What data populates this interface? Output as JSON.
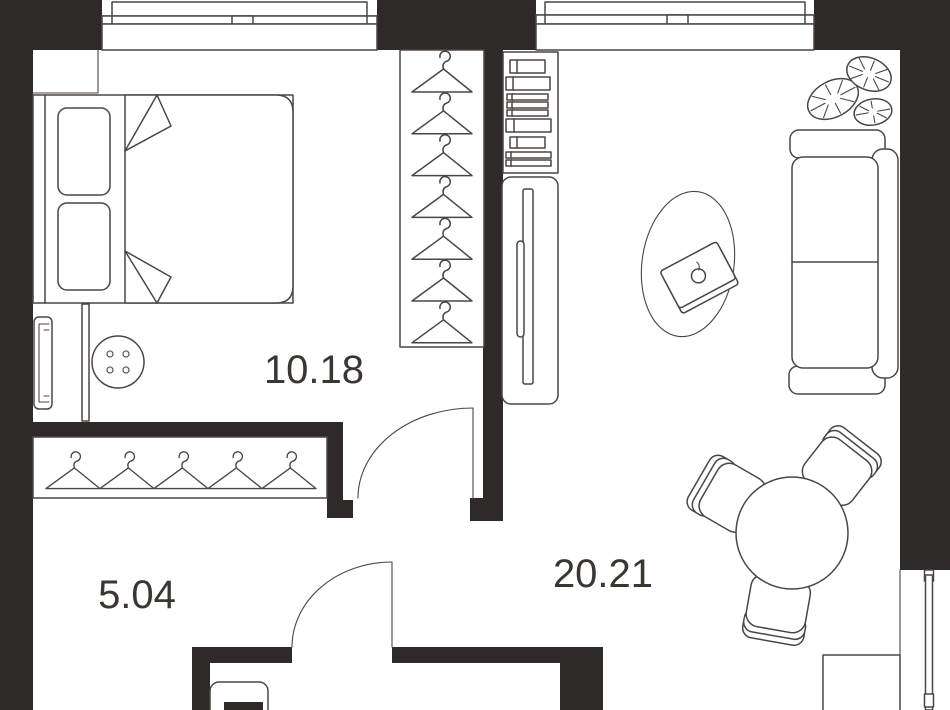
{
  "plan": {
    "type": "apartment-floor-plan",
    "rooms": [
      {
        "id": "bedroom",
        "area_label": "10.18"
      },
      {
        "id": "hallway",
        "area_label": "5.04"
      },
      {
        "id": "living_room",
        "area_label": "20.21"
      }
    ]
  },
  "colors": {
    "wall": "#2e2a27",
    "line": "#4b4643",
    "label": "#3a3632",
    "bg": "#ffffff"
  },
  "wardrobe": {
    "closet_hanger_count": 7,
    "coat_hanger_count": 5
  },
  "icons": [
    "hanger-icon",
    "double-bed",
    "pillow",
    "blanket",
    "radiator",
    "pouf",
    "shelf-unit",
    "tall-cabinet",
    "rug",
    "coffee-table",
    "sofa",
    "monstera-plant",
    "dining-table",
    "dining-chair",
    "tv-stand",
    "washing-machine",
    "door-swing",
    "window"
  ]
}
